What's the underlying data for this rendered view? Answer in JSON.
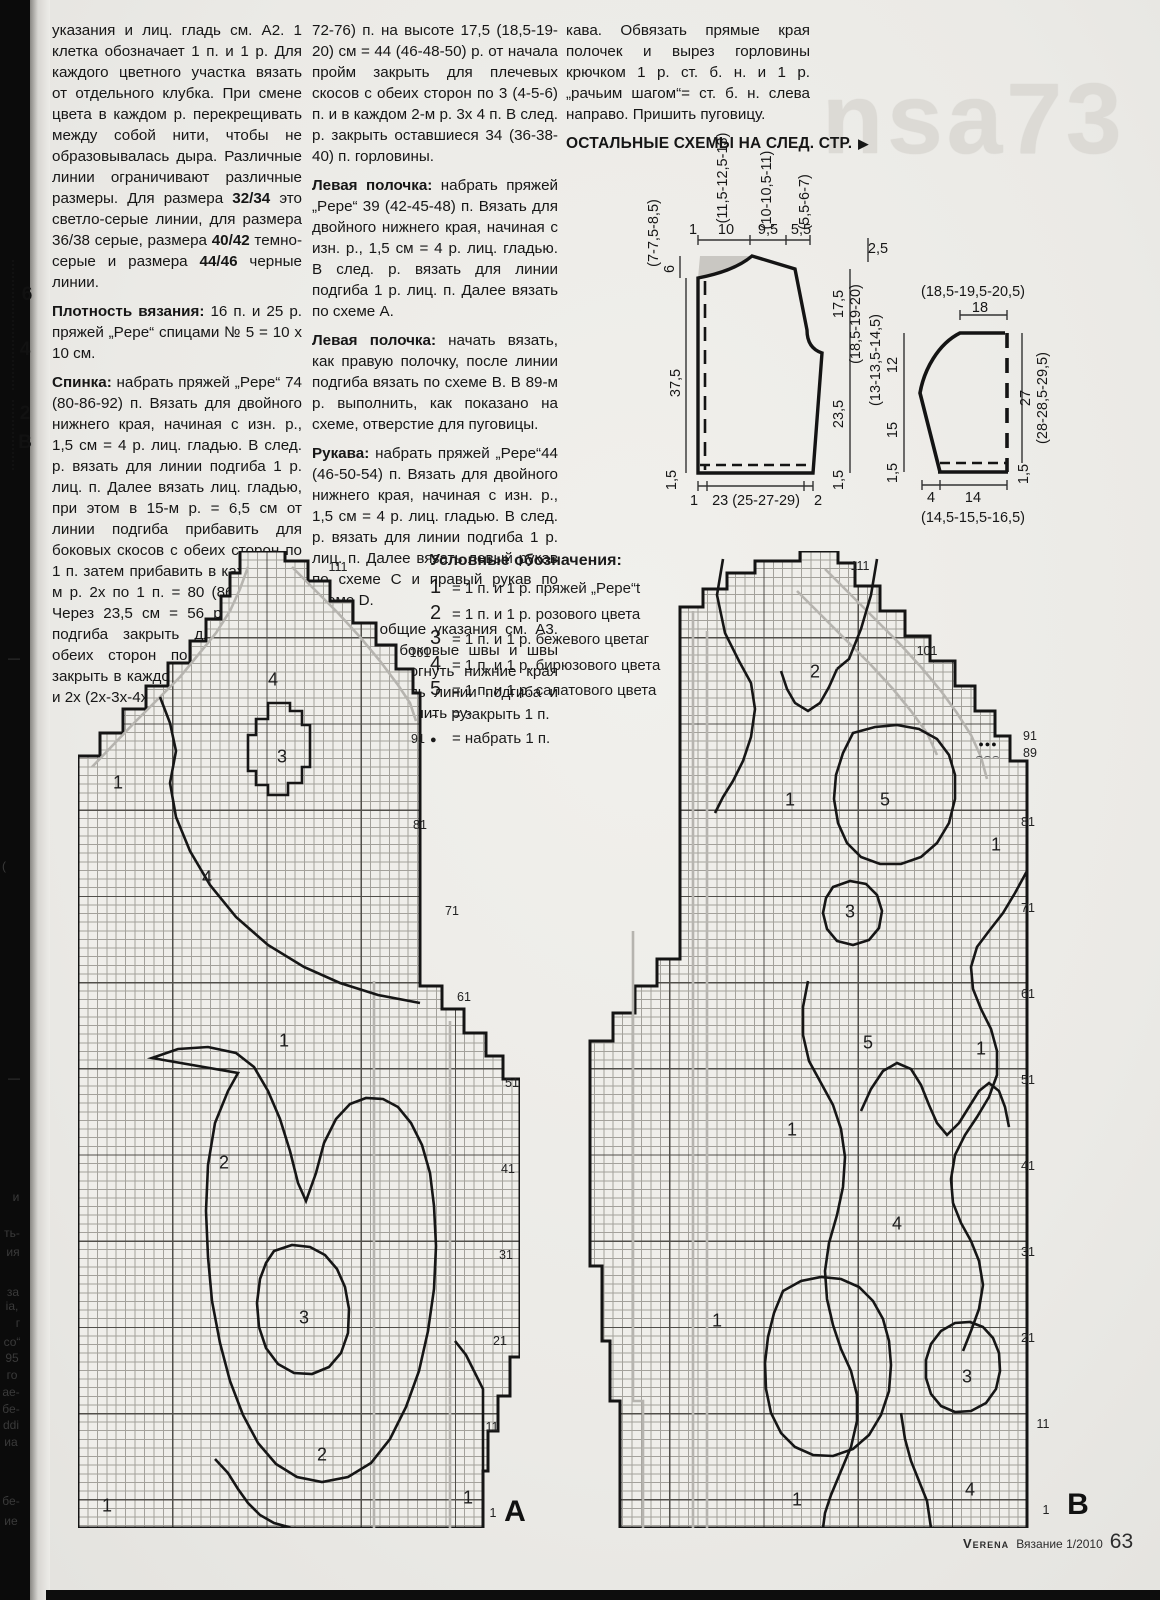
{
  "page": {
    "watermark": "nsa73",
    "footer": {
      "brand": "Verena",
      "issue": "Вязание 1/2010",
      "page": "63"
    },
    "spine_marks": [
      {
        "t": "6",
        "x": 27,
        "y": 295
      },
      {
        "t": "4",
        "x": 25,
        "y": 350
      },
      {
        "t": "2",
        "x": 25,
        "y": 414
      },
      {
        "t": "B",
        "x": 25,
        "y": 443
      }
    ],
    "spine_fragments": [
      {
        "t": "—",
        "x": 14,
        "y": 658
      },
      {
        "t": "(",
        "x": 4,
        "y": 866
      },
      {
        "t": "—",
        "x": 14,
        "y": 1078
      },
      {
        "t": "и",
        "x": 16,
        "y": 1197
      },
      {
        "t": "ть-",
        "x": 12,
        "y": 1233
      },
      {
        "t": "ия",
        "x": 13,
        "y": 1252
      },
      {
        "t": "за",
        "x": 13,
        "y": 1292
      },
      {
        "t": "іа,",
        "x": 12,
        "y": 1306
      },
      {
        "t": "г",
        "x": 18,
        "y": 1323
      },
      {
        "t": "со“",
        "x": 12,
        "y": 1342
      },
      {
        "t": "95",
        "x": 12,
        "y": 1358
      },
      {
        "t": "го",
        "x": 12,
        "y": 1375
      },
      {
        "t": "ае-",
        "x": 11,
        "y": 1392
      },
      {
        "t": "бе-",
        "x": 11,
        "y": 1409
      },
      {
        "t": "ddi",
        "x": 11,
        "y": 1425
      },
      {
        "t": "иа",
        "x": 11,
        "y": 1442
      },
      {
        "t": "бе-",
        "x": 11,
        "y": 1501
      },
      {
        "t": "ие",
        "x": 11,
        "y": 1521
      }
    ]
  },
  "text": {
    "col1": {
      "p1": [
        {
          "t": "указания и лиц. гладь см. А2. 1 клетка обозначает 1 п. и 1 р. Для каждого цветного участка вязать от отдельного клубка. При смене цвета в каждом р. перекрещивать между собой нити, чтобы не образовывалась дыра. Различные линии ограничивают различные размеры. Для размера "
        },
        {
          "t": "32/34",
          "b": true
        },
        {
          "t": " это светло-серые линии, для размера 36/38 серые, размера "
        },
        {
          "t": "40/42",
          "b": true
        },
        {
          "t": " темно-серые и размера "
        },
        {
          "t": "44/46",
          "b": true
        },
        {
          "t": " черные линии."
        }
      ],
      "p2": [
        {
          "t": "Плотность вязания:",
          "b": true
        },
        {
          "t": " 16 п. и 25 р. пряжей „Pepe“ спицами № 5 = 10 x 10 см."
        }
      ],
      "p3": [
        {
          "t": "Спинка:",
          "b": true
        },
        {
          "t": " набрать пряжей „Pepe“ 74 (80-86-92) п. Вязать для двойного нижнего края, начиная с изн. р., 1,5 см = 4 р. лиц. гладью. В след. р. вязать для линии подгиба 1 р. лиц. п. Далее вязать лиц. гладью, при этом в 15-м р. = 6,5 см от линии подгиба прибавить для боковых скосов с обеих сторон по 1 п. затем прибавить в каждом 16-м р. 2х по 1 п. = 80 (86-92-98) п. Через 23,5 см = 56 р. от линии подгиба закрыть для пройм с обеих сторон по 2 (3-3-3) п., закрыть в каждом 2-м р. 2х по 2 п. и 2х (2х-3х-4х) по 1 п. = 64 (68-"
        }
      ]
    },
    "col2": {
      "p1": [
        {
          "t": "72-76) п. на высоте 17,5 (18,5-19-20) см = 44 (46-48-50) р. от начала пройм закрыть для плечевых скосов с обеих сторон по 3 (4-5-6) п. и в каждом 2-м р. 3х 4 п. В след. р. закрыть оставшиеся 34 (36-38-40) п. горловины."
        }
      ],
      "p2": [
        {
          "t": "Левая полочка:",
          "b": true
        },
        {
          "t": " набрать пряжей „Pepe“ 39 (42-45-48) п. Вязать для двойного нижнего края, начиная с изн. р., 1,5 см = 4 р. лиц. гладью. В след. р. вязать для линии подгиба 1 р. лиц. п. Далее вязать по схеме А."
        }
      ],
      "p3": [
        {
          "t": "Левая полочка:",
          "b": true
        },
        {
          "t": " начать вязать, как правую полочку, после линии подгиба вязать по схеме В. В 89-м р. выполнить, как показано на схеме, отверстие для пуговицы."
        }
      ],
      "p4": [
        {
          "t": "Рукава:",
          "b": true
        },
        {
          "t": " набрать пряжей „Pepe“44 (46-50-54) п. Вязать для двойного нижнего края, начиная с изн. р., 1,5 см = 4 р. лиц. гладью. В след. р. вязать для линии подгиба 1 р. лиц. п. Далее вязать левый рукав по схеме С и правый рукав по схеме D."
        }
      ],
      "p5": [
        {
          "t": "Сборка:",
          "b": true
        },
        {
          "t": " общие указания см. А3. Выполнить боковые швы и швы рукавов. Подогнуть нижние края вовнутрь вдоль линии подгиба и подшить их. Вшить ру-"
        }
      ]
    },
    "col3": {
      "p1": [
        {
          "t": "кава. Обвязать прямые края полочек и вырез горловины крючком 1 р. ст. б. н. и 1 р. „рачьим шагом“= ст. б. н. слева направо. Пришить пуговицу."
        }
      ],
      "more_schemes": "ОСТАЛЬНЫЕ СХЕМЫ НА СЛЕД. СТР.",
      "arrow": "▶"
    }
  },
  "legend": {
    "title": "Условные обозначения:",
    "items": [
      {
        "sym": "1",
        "text": "= 1 п. и 1 р. пряжей „Pepe“t"
      },
      {
        "sym": "2",
        "text": "= 1 п. и 1 р. розового цвета"
      },
      {
        "sym": "3",
        "text": "= 1 п. и 1 р. бежевого цветаг"
      },
      {
        "sym": "4",
        "text": "= 1 п. и 1 р. бирюзового цвета"
      },
      {
        "sym": "5",
        "text": "= 1 п. и 1 р. салатового цвета"
      },
      {
        "sym": "⌢",
        "text": "= закрыть 1 п."
      },
      {
        "sym": "●",
        "text": "= набрать 1 п."
      }
    ]
  },
  "schematics": {
    "body": {
      "top_rotated": [
        "(11,5-12,5-13)",
        "(10-10,5-11)",
        "(5,5-6-7)"
      ],
      "top_values": [
        "1",
        "10",
        "9,5",
        "5,5"
      ],
      "left_values": [
        "(7-7,5-8,5)",
        "6",
        "37,5",
        "1,5"
      ],
      "right_values": [
        "2,5",
        "17,5",
        "(18,5-19-20)",
        "23,5",
        "1,5"
      ],
      "bottom_values": [
        "1",
        "23 (25-27-29)",
        "2"
      ]
    },
    "sleeve": {
      "top_rotated": "(18,5-19,5-20,5)",
      "top_value": "18",
      "left_rotated": "(13-13,5-14,5)",
      "left_values": [
        "12",
        "15",
        "1,5"
      ],
      "right_values": [
        "27",
        "(28-28,5-29,5)",
        "1,5"
      ],
      "bottom_values": [
        "4",
        "14",
        "(14,5-15,5-16,5)"
      ]
    }
  },
  "charts": {
    "a": {
      "letter": "A",
      "rows": [
        {
          "t": "111",
          "x": 338,
          "y": 567
        },
        {
          "t": "101",
          "x": 420,
          "y": 653
        },
        {
          "t": "91",
          "x": 418,
          "y": 739
        },
        {
          "t": "81",
          "x": 420,
          "y": 825
        },
        {
          "t": "71",
          "x": 452,
          "y": 911
        },
        {
          "t": "61",
          "x": 464,
          "y": 997
        },
        {
          "t": "51",
          "x": 512,
          "y": 1083
        },
        {
          "t": "41",
          "x": 508,
          "y": 1169
        },
        {
          "t": "31",
          "x": 506,
          "y": 1255
        },
        {
          "t": "21",
          "x": 500,
          "y": 1341
        },
        {
          "t": "11",
          "x": 492,
          "y": 1427
        },
        {
          "t": "1",
          "x": 493,
          "y": 1513
        }
      ],
      "labels": [
        {
          "t": "4",
          "x": 273,
          "y": 680
        },
        {
          "t": "3",
          "x": 282,
          "y": 757
        },
        {
          "t": "1",
          "x": 118,
          "y": 783
        },
        {
          "t": "4",
          "x": 207,
          "y": 878
        },
        {
          "t": "1",
          "x": 284,
          "y": 1041
        },
        {
          "t": "2",
          "x": 224,
          "y": 1163
        },
        {
          "t": "3",
          "x": 304,
          "y": 1318
        },
        {
          "t": "2",
          "x": 322,
          "y": 1455
        },
        {
          "t": "1",
          "x": 107,
          "y": 1506
        },
        {
          "t": "1",
          "x": 468,
          "y": 1498
        }
      ]
    },
    "b": {
      "letter": "B",
      "buttonhole_dots": "●●●",
      "buttonhole_arcs": "⌢⌢⌢",
      "rows": [
        {
          "t": "111",
          "x": 860,
          "y": 566
        },
        {
          "t": "101",
          "x": 927,
          "y": 651
        },
        {
          "t": "91",
          "x": 1030,
          "y": 736
        },
        {
          "t": "89",
          "x": 1030,
          "y": 753
        },
        {
          "t": "81",
          "x": 1028,
          "y": 822
        },
        {
          "t": "71",
          "x": 1028,
          "y": 908
        },
        {
          "t": "61",
          "x": 1028,
          "y": 994
        },
        {
          "t": "51",
          "x": 1028,
          "y": 1080
        },
        {
          "t": "41",
          "x": 1028,
          "y": 1166
        },
        {
          "t": "31",
          "x": 1028,
          "y": 1252
        },
        {
          "t": "21",
          "x": 1028,
          "y": 1338
        },
        {
          "t": "11",
          "x": 1043,
          "y": 1424
        },
        {
          "t": "1",
          "x": 1046,
          "y": 1510
        }
      ],
      "labels": [
        {
          "t": "2",
          "x": 815,
          "y": 672
        },
        {
          "t": "1",
          "x": 790,
          "y": 800
        },
        {
          "t": "5",
          "x": 885,
          "y": 800
        },
        {
          "t": "1",
          "x": 996,
          "y": 845
        },
        {
          "t": "3",
          "x": 850,
          "y": 912
        },
        {
          "t": "5",
          "x": 868,
          "y": 1043
        },
        {
          "t": "1",
          "x": 981,
          "y": 1049
        },
        {
          "t": "1",
          "x": 792,
          "y": 1130
        },
        {
          "t": "4",
          "x": 897,
          "y": 1224
        },
        {
          "t": "1",
          "x": 717,
          "y": 1321
        },
        {
          "t": "3",
          "x": 967,
          "y": 1377
        },
        {
          "t": "1",
          "x": 797,
          "y": 1500
        },
        {
          "t": "4",
          "x": 970,
          "y": 1490
        }
      ]
    }
  }
}
